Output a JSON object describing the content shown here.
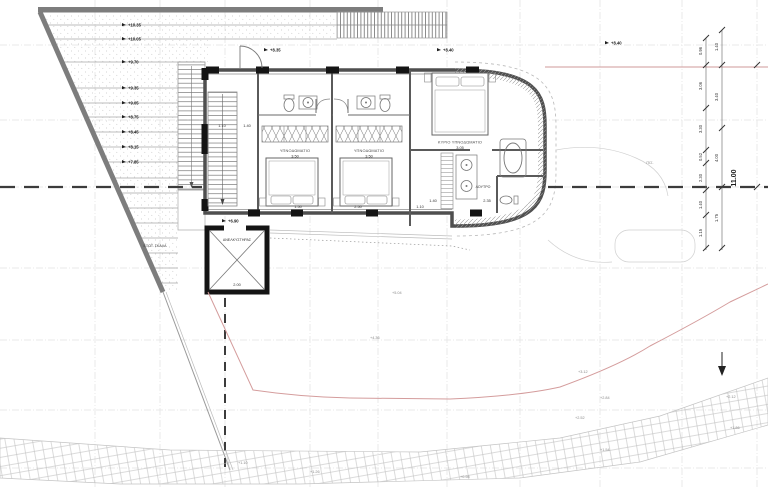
{
  "rooms": {
    "bedroom1": {
      "label": "ΥΠΝΟΔΩΜΑΤΙΟ",
      "dim": "3.50"
    },
    "bedroom2": {
      "label": "ΥΠΝΟΔΩΜΑΤΙΟ",
      "dim": "3.50"
    },
    "master": {
      "label": "ΚΥΡΙΟ ΥΠΝΟΔΩΜΑΤΙΟ",
      "dim": "3.05"
    },
    "bath_master": {
      "label": "ΛΟΥΤΡΟ"
    },
    "elevator": {
      "label": "ΑΝΕΛΚΥΣΤΗΡΑΣ",
      "dim": "2.00"
    },
    "external_stair": {
      "label": "ΕΞΩΤ. ΣΚΑΛΑ"
    },
    "pool": {
      "label": "ΠΙΣ."
    }
  },
  "terrace_levels": [
    "+10.35",
    "+10.05",
    "+9.70",
    "+9.35",
    "+9.05",
    "+8.75",
    "+8.45",
    "+8.15",
    "+7.85"
  ],
  "entry_levels": {
    "door": "+8.35",
    "pergola": "+8.40",
    "right": "+8.40",
    "hall": "+6.90"
  },
  "spot_levels": [
    "+5.04",
    "+4.36",
    "+3.12",
    "+2.84",
    "+2.52",
    "+2.12",
    "+1.86",
    "+1.54",
    "+1.26",
    "+1.10",
    "+0.98"
  ],
  "dims": {
    "wall_bottom": [
      "1.50",
      "2.50",
      "1.10"
    ],
    "bath": [
      "1.40",
      "2.35"
    ],
    "stair": [
      "1.10",
      "1.40"
    ],
    "chain_inner": [
      "0.96",
      "3.06",
      "3.30",
      "0.52",
      "2.30",
      "1.40",
      "1.15"
    ],
    "chain_outer": [
      "1.40",
      "3.40",
      "4.00",
      "1.75"
    ],
    "total": "11.00"
  }
}
